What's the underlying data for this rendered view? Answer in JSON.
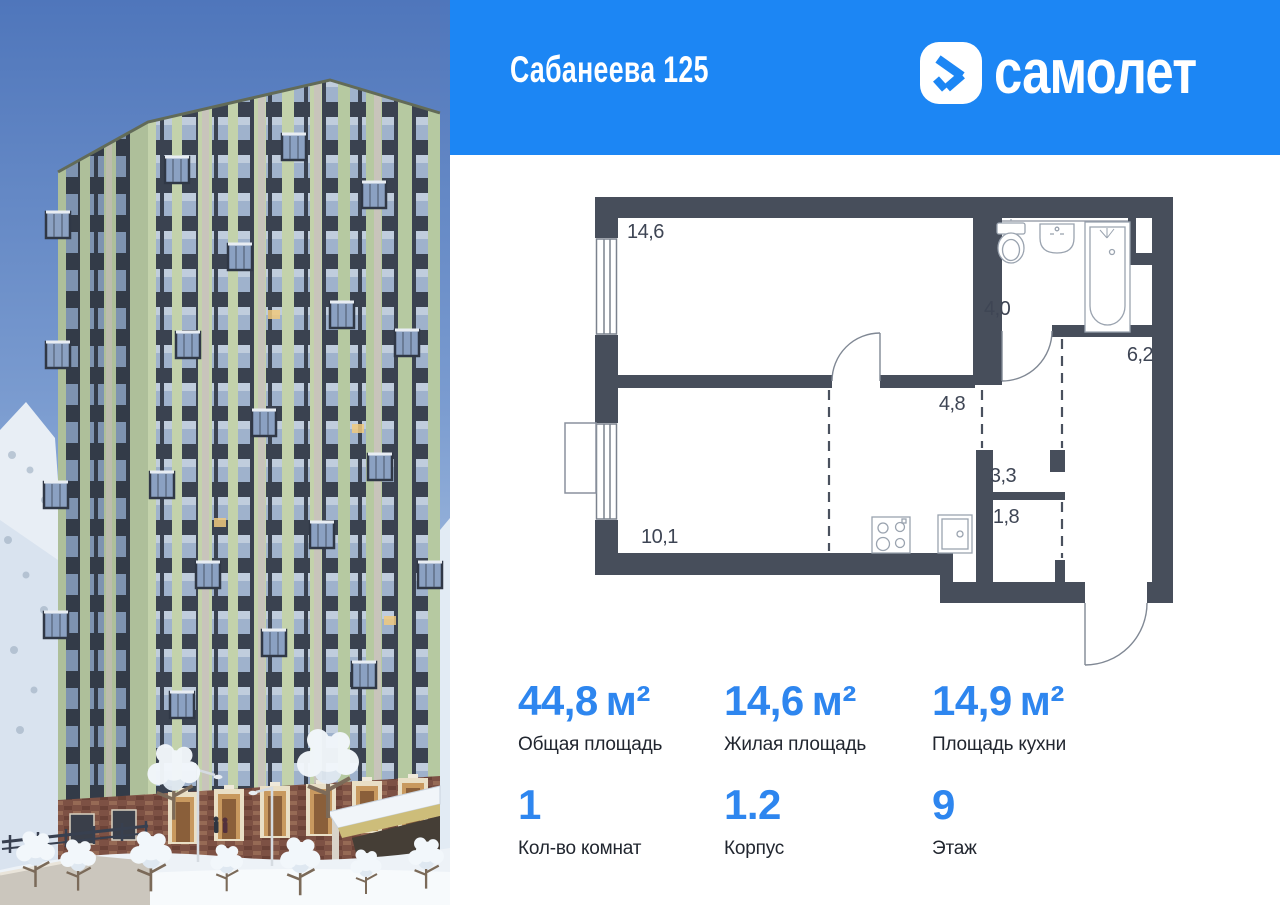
{
  "header": {
    "title": "Сабанеева 125",
    "brand": "самолет"
  },
  "floor_plan": {
    "rooms": [
      {
        "id": "living-room",
        "area_label": "14,6"
      },
      {
        "id": "bathroom",
        "area_label": "4,0"
      },
      {
        "id": "hallway",
        "area_label": "6,2"
      },
      {
        "id": "corridor",
        "area_label": "4,8"
      },
      {
        "id": "storage",
        "area_label": "3,3"
      },
      {
        "id": "wardrobe",
        "area_label": "1,8"
      },
      {
        "id": "kitchen",
        "area_label": "10,1"
      }
    ]
  },
  "stats": {
    "primary": [
      {
        "value": "44,8",
        "unit": "м²",
        "label": "Общая площадь"
      },
      {
        "value": "14,6",
        "unit": "м²",
        "label": "Жилая площадь"
      },
      {
        "value": "14,9",
        "unit": "м²",
        "label": "Площадь кухни"
      }
    ],
    "secondary": [
      {
        "value": "1",
        "label": "Кол-во комнат"
      },
      {
        "value": "1.2",
        "label": "Корпус"
      },
      {
        "value": "9",
        "label": "Этаж"
      }
    ]
  },
  "colors": {
    "brand_blue": "#1c86f4",
    "stat_value_blue": "#2e86ef",
    "plan_wall": "#474e5b",
    "facade_green": "#c3d2ab",
    "sky_blue": "#4f76bb"
  }
}
